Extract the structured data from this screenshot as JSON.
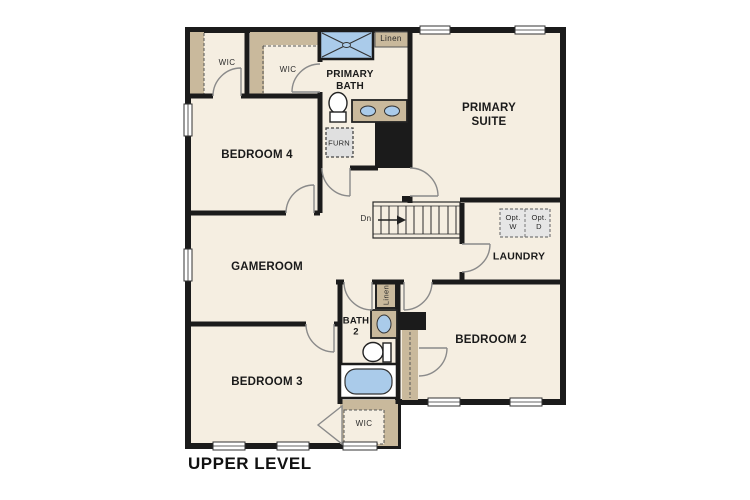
{
  "title": "UPPER LEVEL",
  "rooms": {
    "primary_suite": "PRIMARY\nSUITE",
    "primary_bath": "PRIMARY\nBATH",
    "bedroom_4": "BEDROOM 4",
    "gameroom": "GAMEROOM",
    "bedroom_3": "BEDROOM 3",
    "bedroom_2": "BEDROOM 2",
    "bath_2": "BATH\n2",
    "laundry": "LAUNDRY"
  },
  "closets": {
    "wic_left": "WIC",
    "wic_top": "WIC",
    "wic_bottom": "WIC",
    "linen_top": "Linen",
    "linen_hall": "Linen"
  },
  "labels": {
    "furnace": "FURN",
    "stairs_direction": "Dn",
    "opt_washer": "Opt.\nW",
    "opt_dryer": "Opt.\nD"
  },
  "colors": {
    "floor": "#f5eee1",
    "wall": "#1b1b1b",
    "closet_tan": "#c9b99c",
    "fixture_blue": "#aacbea",
    "appliance_gray": "#e6e6e6",
    "door_stroke": "#8a8a8a"
  }
}
